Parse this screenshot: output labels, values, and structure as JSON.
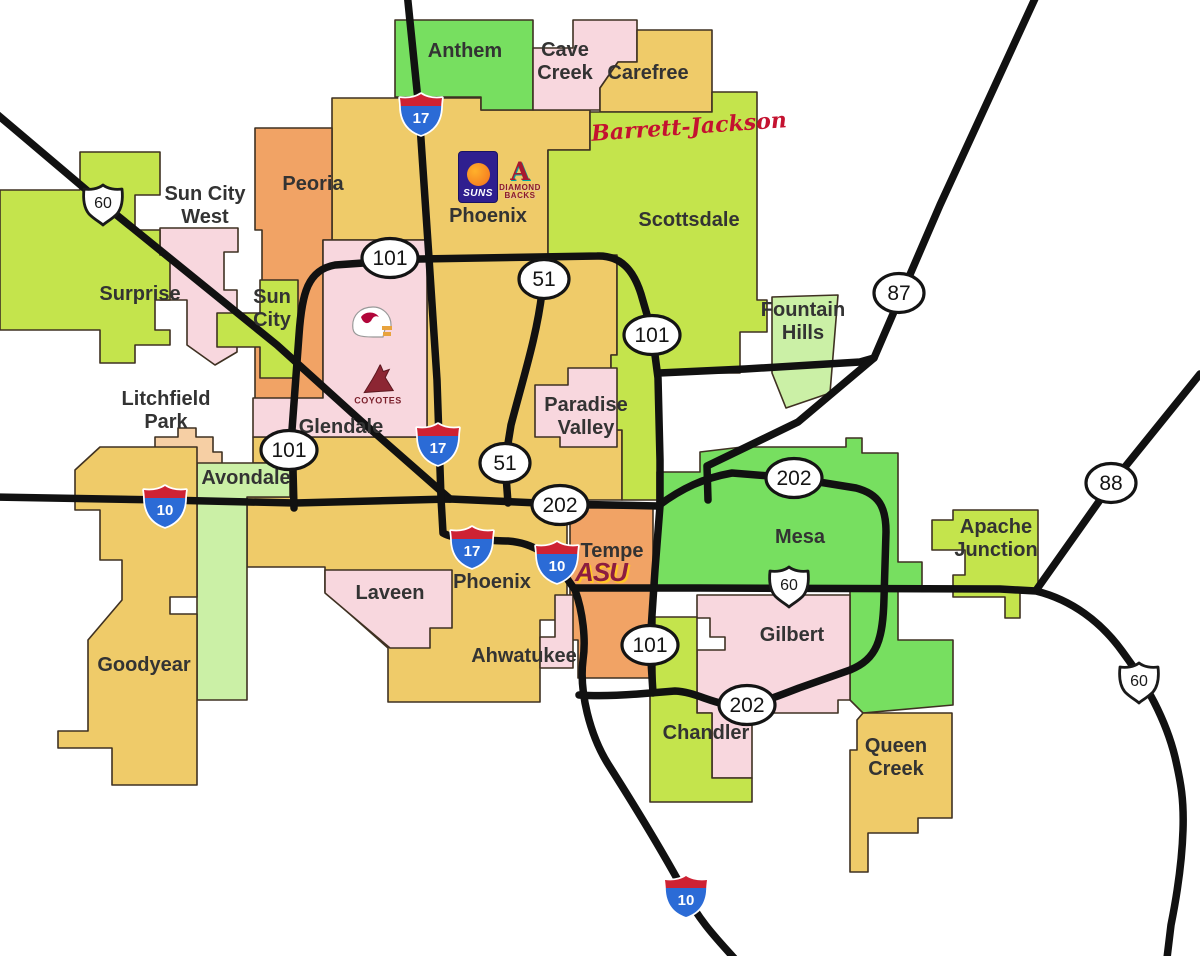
{
  "map": {
    "title": "Phoenix metropolitan area map",
    "colors": {
      "background": "#ffffff",
      "gold": "#EFCB69",
      "yellow_green": "#C4E44C",
      "green": "#77DF60",
      "light_green": "#CBF0A6",
      "pink": "#F8D7DE",
      "orange": "#F1A365",
      "peach": "#F6CFA4",
      "border": "#3F3122",
      "road": "#111111",
      "interstate_red": "#CE2233",
      "interstate_blue": "#2B6BD6",
      "label": "#333333"
    },
    "regions": [
      {
        "id": "phoenix-main",
        "color": "gold",
        "points": "332,98 481,98 481,110 590,110 590,150 548,150 548,255 617,255 617,355 611,355 611,430 622,430 622,500 567,500 567,620 540,620 540,702 388,702 388,648 325,592 325,567 247,567 247,497 290,497 290,463 253,463 253,437 427,437 427,240 332,240"
      },
      {
        "id": "anthem",
        "color": "green",
        "points": "395,20 533,20 533,110 481,110 481,97 395,97"
      },
      {
        "id": "cave-creek",
        "color": "pink",
        "points": "533,48 573,48 573,20 637,20 637,62 618,62 600,88 600,110 533,110"
      },
      {
        "id": "carefree",
        "color": "gold",
        "points": "618,62 637,62 637,30 712,30 712,112 600,112 600,88"
      },
      {
        "id": "scottsdale",
        "color": "yellow_green",
        "points": "590,112 712,112 712,92 757,92 757,300 767,300 767,332 740,332 740,373 660,373 660,500 622,500 622,430 611,430 611,355 617,355 617,255 548,255 548,150 590,150"
      },
      {
        "id": "fountain-hills",
        "color": "light_green",
        "points": "772,297 838,295 830,393 786,408 772,373"
      },
      {
        "id": "peoria",
        "color": "orange",
        "points": "255,128 332,128 332,240 323,240 323,400 255,400 255,340 262,340 262,230 255,230"
      },
      {
        "id": "sun-city-west",
        "color": "pink",
        "points": "160,228 238,228 238,252 224,252 224,290 237,290 237,352 215,365 187,345 187,300 160,300"
      },
      {
        "id": "sun-city",
        "color": "yellow_green",
        "points": "260,280 298,280 298,378 260,378 260,347 217,347 217,313 260,313"
      },
      {
        "id": "surprise",
        "color": "yellow_green",
        "points": "0,190 80,190 80,152 160,152 160,195 135,195 135,230 160,230 160,255 170,255 170,300 155,300 155,330 170,330 170,345 135,345 135,363 100,363 100,330 0,330"
      },
      {
        "id": "glendale",
        "color": "pink",
        "points": "323,240 427,240 427,437 253,437 253,398 323,398"
      },
      {
        "id": "litchfield-park",
        "color": "peach",
        "points": "155,437 178,437 178,428 196,428 196,437 213,437 213,452 222,452 222,472 196,472 185,465 155,465"
      },
      {
        "id": "avondale",
        "color": "light_green",
        "points": "197,463 290,463 290,497 247,497 247,700 197,700"
      },
      {
        "id": "goodyear",
        "color": "gold",
        "points": "100,447 197,447 197,597 170,597 170,614 197,614 197,785 112,785 112,748 58,748 58,731 88,731 88,640 122,600 122,560 100,560 100,510 75,510 75,470"
      },
      {
        "id": "laveen",
        "color": "pink",
        "points": "325,570 452,570 452,628 430,628 430,648 390,648 325,593"
      },
      {
        "id": "paradise-valley",
        "color": "pink",
        "points": "535,385 568,385 568,368 617,368 617,447 560,447 560,437 535,437"
      },
      {
        "id": "tempe",
        "color": "orange",
        "points": "570,508 653,508 653,678 578,678 578,640 570,640"
      },
      {
        "id": "ahwatukee-strip",
        "color": "pink",
        "points": "555,595 573,595 573,668 540,668 540,637 555,637"
      },
      {
        "id": "mesa",
        "color": "green",
        "points": "657,508 657,472 700,472 700,452 742,447 846,447 846,438 862,438 862,453 898,453 898,562 922,562 922,588 657,588"
      },
      {
        "id": "mesa-east",
        "color": "green",
        "points": "850,588 898,588 898,640 953,640 953,705 863,713 850,700"
      },
      {
        "id": "apache-junction",
        "color": "yellow_green",
        "points": "953,510 1038,510 1038,593 1020,593 1020,618 1005,618 1005,597 953,597 953,575 965,575 965,550 932,550 932,520 953,520"
      },
      {
        "id": "gilbert",
        "color": "pink",
        "points": "697,595 850,595 850,700 838,700 838,713 752,713 752,778 712,778 712,713 697,713 697,650 725,650 725,637 710,637 710,618 697,618"
      },
      {
        "id": "chandler",
        "color": "yellow_green",
        "points": "655,617 697,617 697,713 712,713 712,778 752,778 752,802 650,802 650,687 655,687"
      },
      {
        "id": "queen-creek",
        "color": "gold",
        "points": "863,713 952,713 952,818 918,818 918,833 868,833 868,872 850,872 850,750 857,750 857,720"
      }
    ],
    "labels": [
      {
        "id": "anthem",
        "lines": [
          "Anthem"
        ],
        "x": 465,
        "y": 57
      },
      {
        "id": "cave-creek",
        "lines": [
          "Cave",
          "Creek"
        ],
        "x": 565,
        "y": 56
      },
      {
        "id": "carefree",
        "lines": [
          "Carefree"
        ],
        "x": 648,
        "y": 79
      },
      {
        "id": "sun-city-west",
        "lines": [
          "Sun City",
          "West"
        ],
        "x": 205,
        "y": 200
      },
      {
        "id": "peoria",
        "lines": [
          "Peoria"
        ],
        "x": 313,
        "y": 190
      },
      {
        "id": "phoenix-north",
        "lines": [
          "Phoenix"
        ],
        "x": 488,
        "y": 222
      },
      {
        "id": "scottsdale",
        "lines": [
          "Scottsdale"
        ],
        "x": 689,
        "y": 226
      },
      {
        "id": "surprise",
        "lines": [
          "Surprise"
        ],
        "x": 140,
        "y": 300
      },
      {
        "id": "sun-city",
        "lines": [
          "Sun",
          "City"
        ],
        "x": 272,
        "y": 303
      },
      {
        "id": "fountain-hills",
        "lines": [
          "Fountain",
          "Hills"
        ],
        "x": 803,
        "y": 316
      },
      {
        "id": "litchfield-park",
        "lines": [
          "Litchfield",
          "Park"
        ],
        "x": 166,
        "y": 405
      },
      {
        "id": "glendale",
        "lines": [
          "Glendale"
        ],
        "x": 341,
        "y": 433
      },
      {
        "id": "paradise-valley",
        "lines": [
          "Paradise",
          "Valley"
        ],
        "x": 586,
        "y": 411
      },
      {
        "id": "avondale",
        "lines": [
          "Avondale"
        ],
        "x": 246,
        "y": 484
      },
      {
        "id": "mesa",
        "lines": [
          "Mesa"
        ],
        "x": 800,
        "y": 543
      },
      {
        "id": "apache-junction",
        "lines": [
          "Apache",
          "Junction"
        ],
        "x": 996,
        "y": 533
      },
      {
        "id": "tempe",
        "lines": [
          "Tempe"
        ],
        "x": 612,
        "y": 557
      },
      {
        "id": "laveen",
        "lines": [
          "Laveen"
        ],
        "x": 390,
        "y": 599
      },
      {
        "id": "phoenix-south",
        "lines": [
          "Phoenix"
        ],
        "x": 492,
        "y": 588
      },
      {
        "id": "goodyear",
        "lines": [
          "Goodyear"
        ],
        "x": 144,
        "y": 671
      },
      {
        "id": "ahwatukee",
        "lines": [
          "Ahwatukee"
        ],
        "x": 524,
        "y": 662
      },
      {
        "id": "gilbert",
        "lines": [
          "Gilbert"
        ],
        "x": 792,
        "y": 641
      },
      {
        "id": "chandler",
        "lines": [
          "Chandler"
        ],
        "x": 706,
        "y": 739
      },
      {
        "id": "queen-creek",
        "lines": [
          "Queen",
          "Creek"
        ],
        "x": 896,
        "y": 752
      }
    ],
    "roads": [
      {
        "id": "us60-grand",
        "d": "M -8 110 L 103 204 L 277 345 L 360 420 L 450 499"
      },
      {
        "id": "i10-west",
        "d": "M -8 497 L 165 500 L 295 503 L 450 499 L 560 504 L 658 506"
      },
      {
        "id": "i17-i10",
        "d": "M 407 -8 L 419 110 L 429 258 L 437 380 L 441 498 L 443 533 C 455 540 480 540 508 541 C 536 543 553 558 566 577 L 575 590 C 583 612 586 640 583 660 C 579 692 590 735 608 764 C 629 797 659 845 685 893 C 700 922 718 940 734 958"
      },
      {
        "id": "loop101",
        "d": "M 294 508 L 292 430 L 299 335 C 302 292 308 270 335 265 L 420 259 L 597 256 C 622 255 634 272 641 294 L 652 332 L 658 378 L 660 460 L 660 506 L 655 570 L 650 645 L 653 693"
      },
      {
        "id": "sr51",
        "d": "M 540 262 L 542 292 C 537 335 524 375 511 425 L 505 462 L 508 503"
      },
      {
        "id": "loop202",
        "d": "M 658 506 C 682 488 704 478 732 473 L 794 478 L 856 488 C 879 494 886 507 886 532 L 884 598 C 883 640 877 659 850 670 L 799 688 C 773 698 760 703 747 705 C 719 709 699 692 675 691 L 638 694 C 612 696 593 696 579 695"
      },
      {
        "id": "shea-blvd",
        "d": "M 659 373 L 745 369 L 860 362 L 874 358"
      },
      {
        "id": "sr87",
        "d": "M 1038 -8 L 940 205 L 874 358 L 798 422 L 707 466 L 708 500"
      },
      {
        "id": "us60-east",
        "d": "M 574 588 L 700 588 L 1000 589 L 1036 591 C 1072 600 1101 622 1122 651 C 1146 683 1166 720 1175 757 C 1181 783 1184 800 1183 830 C 1182 862 1177 895 1171 925 L 1167 958"
      },
      {
        "id": "sr88",
        "d": "M 1200 374 L 1112 483 L 1037 589"
      }
    ],
    "markers": [
      {
        "type": "interstate",
        "label": "17",
        "x": 421,
        "y": 114
      },
      {
        "type": "interstate",
        "label": "17",
        "x": 438,
        "y": 444
      },
      {
        "type": "interstate",
        "label": "17",
        "x": 472,
        "y": 547
      },
      {
        "type": "interstate",
        "label": "10",
        "x": 165,
        "y": 506
      },
      {
        "type": "interstate",
        "label": "10",
        "x": 557,
        "y": 562
      },
      {
        "type": "interstate",
        "label": "10",
        "x": 686,
        "y": 896
      },
      {
        "type": "us",
        "label": "60",
        "x": 103,
        "y": 204
      },
      {
        "type": "us",
        "label": "60",
        "x": 789,
        "y": 586
      },
      {
        "type": "us",
        "label": "60",
        "x": 1139,
        "y": 682
      },
      {
        "type": "ellipse",
        "label": "101",
        "x": 390,
        "y": 258
      },
      {
        "type": "ellipse",
        "label": "101",
        "x": 652,
        "y": 335
      },
      {
        "type": "ellipse",
        "label": "101",
        "x": 289,
        "y": 450
      },
      {
        "type": "ellipse",
        "label": "101",
        "x": 650,
        "y": 645
      },
      {
        "type": "ellipse",
        "label": "51",
        "x": 544,
        "y": 279,
        "rx": 25
      },
      {
        "type": "ellipse",
        "label": "51",
        "x": 505,
        "y": 463,
        "rx": 25
      },
      {
        "type": "ellipse",
        "label": "202",
        "x": 560,
        "y": 505
      },
      {
        "type": "ellipse",
        "label": "202",
        "x": 794,
        "y": 478
      },
      {
        "type": "ellipse",
        "label": "202",
        "x": 747,
        "y": 705
      },
      {
        "type": "ellipse",
        "label": "87",
        "x": 899,
        "y": 293,
        "rx": 25
      },
      {
        "type": "ellipse",
        "label": "88",
        "x": 1111,
        "y": 483,
        "rx": 25
      }
    ],
    "logos": [
      {
        "id": "suns",
        "x": 478,
        "y": 177
      },
      {
        "id": "dbacks",
        "x": 520,
        "y": 180
      },
      {
        "id": "cardinals",
        "x": 371,
        "y": 325
      },
      {
        "id": "coyotes",
        "x": 378,
        "y": 385
      },
      {
        "id": "barrett",
        "x": 689,
        "y": 127
      },
      {
        "id": "asu",
        "x": 601,
        "y": 572
      }
    ],
    "logo_text": {
      "suns": "SUNS",
      "dbacks_a": "A",
      "dbacks_line1": "DIAMOND",
      "dbacks_line2": "BACKS",
      "coyotes": "COYOTES",
      "barrett": "Barrett-Jackson",
      "asu": "ASU"
    }
  }
}
